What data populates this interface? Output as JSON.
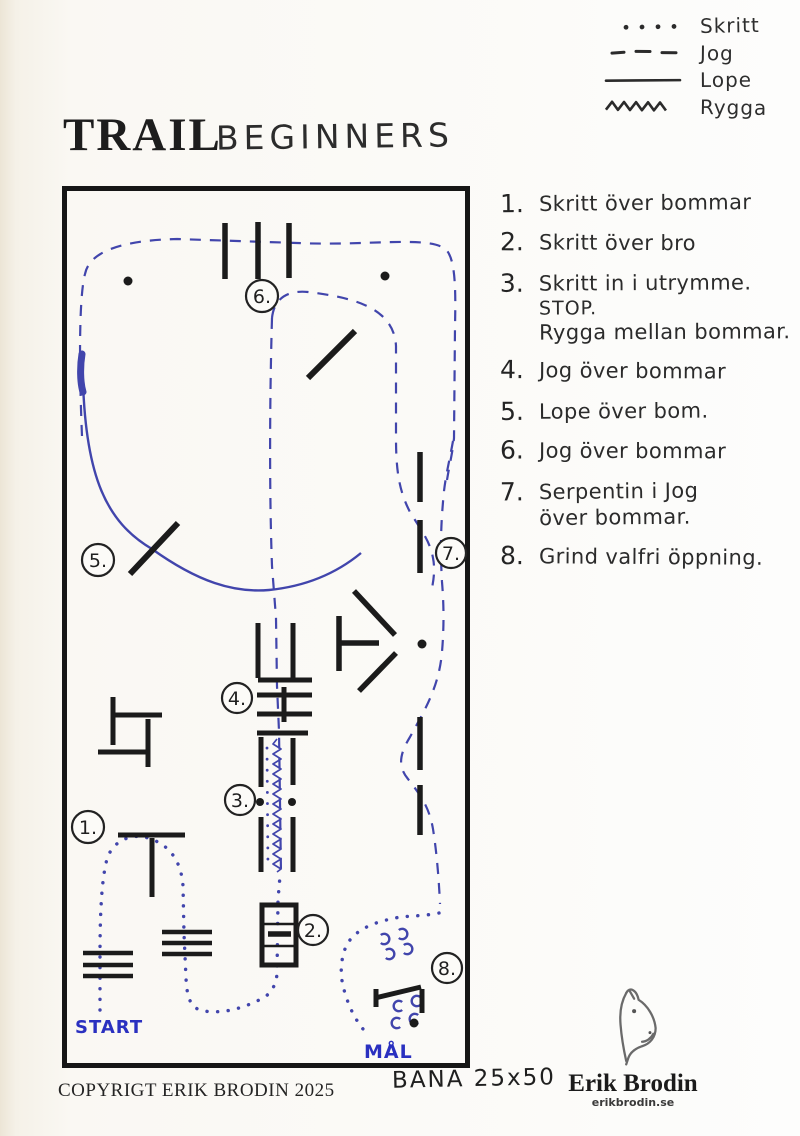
{
  "legend": {
    "items": [
      {
        "name": "skritt",
        "style": "dotted",
        "label": "Skritt"
      },
      {
        "name": "jog",
        "style": "dashed",
        "label": "Jog"
      },
      {
        "name": "lope",
        "style": "solid",
        "label": "Lope"
      },
      {
        "name": "rygga",
        "style": "zigzag",
        "label": "Rygga"
      }
    ]
  },
  "title": {
    "printed": "TRAIL",
    "handwritten": "BEGINNERS"
  },
  "instructions": [
    {
      "num": "1.",
      "line1": "Skritt över bommar"
    },
    {
      "num": "2.",
      "line1": "Skritt över bro"
    },
    {
      "num": "3.",
      "line1": "Skritt in i utrymme.",
      "line2": "STOP.",
      "line3": "Rygga mellan bommar."
    },
    {
      "num": "4.",
      "line1": "Jog över bommar"
    },
    {
      "num": "5.",
      "line1": "Lope över bom."
    },
    {
      "num": "6.",
      "line1": "Jog över bommar"
    },
    {
      "num": "7.",
      "line1": "Serpentin i Jog",
      "line2": "över bommar."
    },
    {
      "num": "8.",
      "line1": "Grind valfri öppning."
    }
  ],
  "course": {
    "markers": [
      {
        "label": "1."
      },
      {
        "label": "2."
      },
      {
        "label": "3."
      },
      {
        "label": "4."
      },
      {
        "label": "5."
      },
      {
        "label": "6."
      },
      {
        "label": "7."
      },
      {
        "label": "8."
      }
    ],
    "start_label": "START",
    "goal_label": "MÅL"
  },
  "footer": {
    "copyright": "COPYRIGT ERIK BRODIN 2025",
    "arena_size": "BANA 25x50"
  },
  "logo": {
    "name": "Erik Brodin",
    "website": "erikbrodin.se"
  },
  "colors": {
    "ink": "#1b1b1b",
    "pen_blue": "#4145ac",
    "pen_blue_bright": "#2a30c0"
  }
}
